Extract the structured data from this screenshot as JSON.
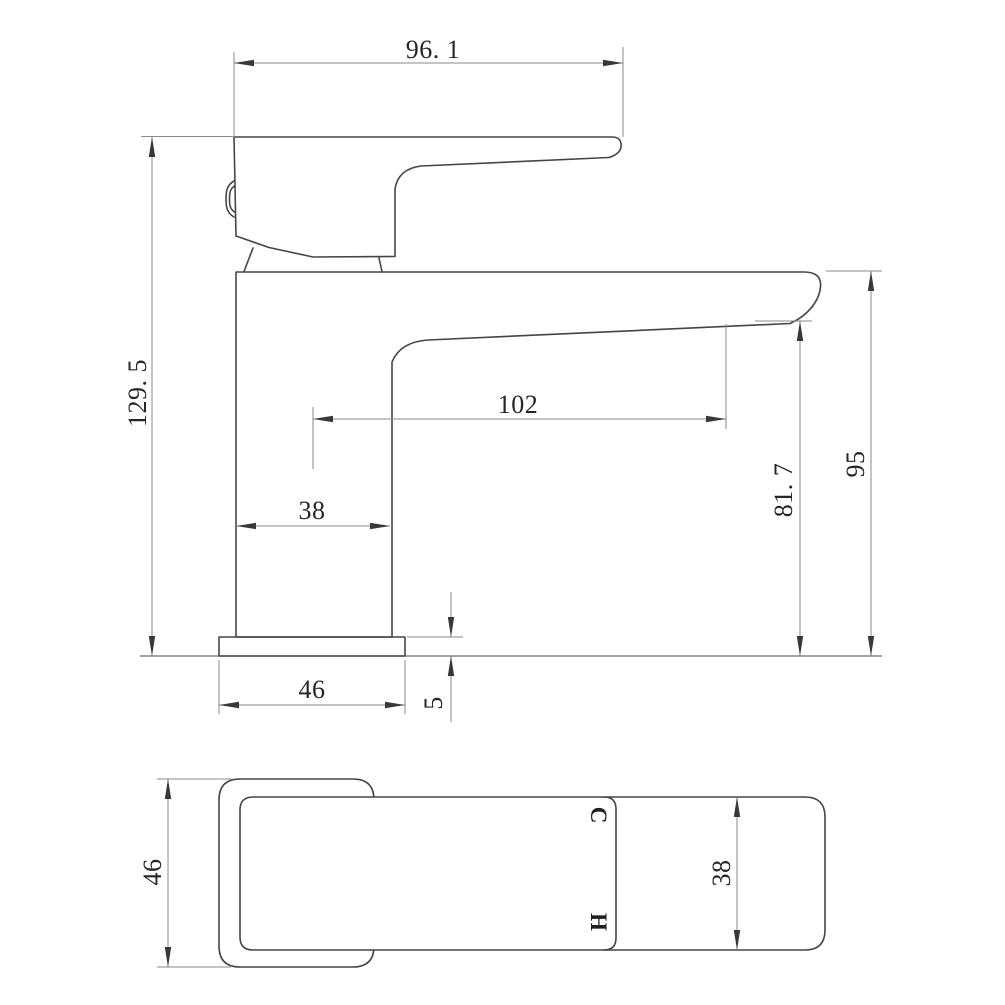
{
  "drawing": {
    "kind": "faucet dimension drawing",
    "side_view": {
      "dim_handle_length": "96. 1",
      "dim_overall_height": "129. 5",
      "dim_spout_reach": "102",
      "dim_body_width": "38",
      "dim_base_width": "46",
      "dim_base_thickness": "5",
      "dim_outlet_height": "81. 7",
      "dim_spout_top_height": "95"
    },
    "plan_view": {
      "dim_base_width": "46",
      "dim_spout_width": "38",
      "label_cold": "C",
      "label_hot": "H"
    },
    "colors": {
      "background": "#ffffff",
      "object_line": "#454545",
      "dimension_line": "#8a8a8a",
      "text": "#262626"
    }
  }
}
